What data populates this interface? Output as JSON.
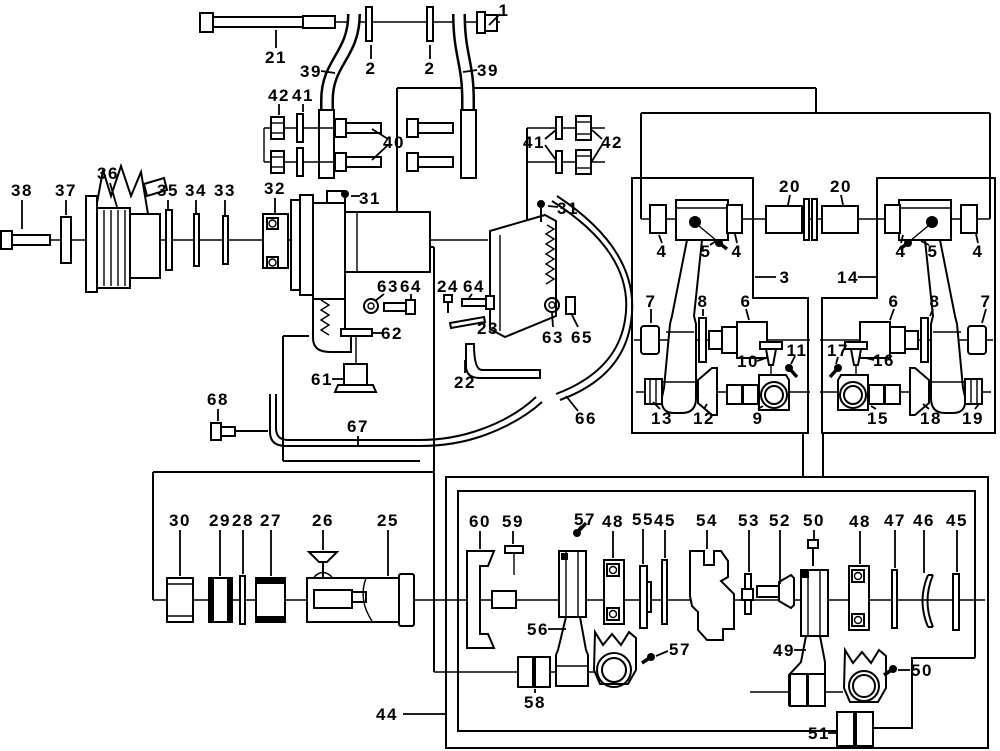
{
  "canvas": {
    "width": 1000,
    "height": 751,
    "background": "#ffffff",
    "line_color": "#000000"
  },
  "diagram": {
    "type": "exploded-parts-diagram",
    "description": "mechanical exploded parts diagram with numbered callouts",
    "part_labels": [
      {
        "text": "1",
        "x": 504,
        "y": 10,
        "leaders": [
          [
            500,
            14,
            489,
            25
          ]
        ]
      },
      {
        "text": "21",
        "x": 276,
        "y": 57,
        "leaders": [
          [
            276,
            48,
            276,
            30
          ]
        ]
      },
      {
        "text": "39",
        "x": 311,
        "y": 71,
        "leaders": [
          [
            321,
            71,
            335,
            73
          ]
        ]
      },
      {
        "text": "2",
        "x": 371,
        "y": 68,
        "leaders": [
          [
            371,
            59,
            371,
            45
          ]
        ]
      },
      {
        "text": "2",
        "x": 430,
        "y": 68,
        "leaders": [
          [
            430,
            59,
            430,
            45
          ]
        ]
      },
      {
        "text": "39",
        "x": 488,
        "y": 70,
        "leaders": [
          [
            477,
            70,
            463,
            72
          ]
        ]
      },
      {
        "text": "42",
        "x": 279,
        "y": 95,
        "leaders": [
          [
            279,
            104,
            279,
            115
          ]
        ]
      },
      {
        "text": "41",
        "x": 303,
        "y": 95,
        "leaders": [
          [
            303,
            104,
            303,
            112
          ]
        ]
      },
      {
        "text": "40",
        "x": 394,
        "y": 142,
        "leaders": [
          [
            388,
            139,
            372,
            129
          ],
          [
            388,
            145,
            372,
            160
          ]
        ]
      },
      {
        "text": "41",
        "x": 534,
        "y": 142,
        "leaders": [
          [
            545,
            139,
            556,
            130
          ],
          [
            545,
            145,
            556,
            160
          ]
        ]
      },
      {
        "text": "42",
        "x": 612,
        "y": 142,
        "leaders": [
          [
            602,
            139,
            592,
            130
          ],
          [
            602,
            145,
            592,
            161
          ]
        ]
      },
      {
        "text": "31",
        "x": 370,
        "y": 198,
        "leaders": [
          [
            360,
            196,
            351,
            196
          ]
        ]
      },
      {
        "text": "31",
        "x": 568,
        "y": 208,
        "leaders": [
          [
            558,
            207,
            548,
            206
          ]
        ]
      },
      {
        "text": "38",
        "x": 22,
        "y": 190,
        "leaders": [
          [
            22,
            200,
            22,
            229
          ]
        ]
      },
      {
        "text": "37",
        "x": 66,
        "y": 190,
        "leaders": [
          [
            66,
            200,
            66,
            215
          ]
        ]
      },
      {
        "text": "36",
        "x": 108,
        "y": 173,
        "leaders": [
          [
            110,
            183,
            117,
            207
          ]
        ]
      },
      {
        "text": "35",
        "x": 168,
        "y": 190,
        "leaders": [
          [
            168,
            200,
            168,
            209
          ]
        ]
      },
      {
        "text": "34",
        "x": 196,
        "y": 190,
        "leaders": [
          [
            196,
            200,
            196,
            213
          ]
        ]
      },
      {
        "text": "33",
        "x": 225,
        "y": 190,
        "leaders": [
          [
            225,
            200,
            225,
            215
          ]
        ]
      },
      {
        "text": "32",
        "x": 275,
        "y": 188,
        "leaders": [
          [
            275,
            198,
            275,
            213
          ]
        ]
      },
      {
        "text": "63",
        "x": 388,
        "y": 286,
        "leaders": [
          [
            384,
            294,
            375,
            301
          ]
        ]
      },
      {
        "text": "64",
        "x": 411,
        "y": 286,
        "leaders": [
          [
            411,
            294,
            411,
            299
          ]
        ]
      },
      {
        "text": "24",
        "x": 448,
        "y": 286,
        "leaders": [
          [
            448,
            294,
            448,
            294
          ]
        ]
      },
      {
        "text": "64",
        "x": 474,
        "y": 286,
        "leaders": [
          [
            472,
            294,
            469,
            298
          ]
        ]
      },
      {
        "text": "23",
        "x": 488,
        "y": 328,
        "leaders": [
          [
            479,
            325,
            486,
            322
          ]
        ]
      },
      {
        "text": "62",
        "x": 392,
        "y": 333,
        "leaders": [
          [
            382,
            333,
            373,
            333
          ]
        ]
      },
      {
        "text": "61",
        "x": 322,
        "y": 379,
        "leaders": [
          [
            332,
            379,
            343,
            379
          ]
        ]
      },
      {
        "text": "22",
        "x": 465,
        "y": 382,
        "leaders": [
          [
            465,
            373,
            465,
            360
          ]
        ]
      },
      {
        "text": "63",
        "x": 553,
        "y": 337,
        "leaders": [
          [
            553,
            327,
            552,
            313
          ]
        ]
      },
      {
        "text": "65",
        "x": 582,
        "y": 337,
        "leaders": [
          [
            578,
            327,
            572,
            315
          ]
        ]
      },
      {
        "text": "66",
        "x": 586,
        "y": 418,
        "leaders": [
          [
            578,
            411,
            566,
            396
          ]
        ]
      },
      {
        "text": "67",
        "x": 358,
        "y": 426,
        "leaders": [
          [
            358,
            436,
            358,
            445
          ]
        ]
      },
      {
        "text": "68",
        "x": 218,
        "y": 399,
        "leaders": [
          [
            218,
            409,
            218,
            421
          ]
        ]
      },
      {
        "text": "20",
        "x": 790,
        "y": 186,
        "leaders": [
          [
            790,
            195,
            788,
            205
          ]
        ]
      },
      {
        "text": "20",
        "x": 841,
        "y": 186,
        "leaders": [
          [
            841,
            195,
            843,
            205
          ]
        ]
      },
      {
        "text": "3",
        "x": 785,
        "y": 277,
        "leaders": [
          [
            776,
            277,
            755,
            277
          ]
        ]
      },
      {
        "text": "14",
        "x": 848,
        "y": 277,
        "leaders": [
          [
            858,
            277,
            876,
            277
          ]
        ]
      },
      {
        "text": "4",
        "x": 662,
        "y": 251,
        "leaders": [
          [
            662,
            243,
            659,
            235
          ]
        ]
      },
      {
        "text": "5",
        "x": 706,
        "y": 251,
        "leaders": [
          [
            710,
            245,
            716,
            241
          ]
        ]
      },
      {
        "text": "4",
        "x": 737,
        "y": 251,
        "leaders": [
          [
            737,
            243,
            735,
            234
          ]
        ]
      },
      {
        "text": "7",
        "x": 651,
        "y": 301,
        "leaders": [
          [
            651,
            309,
            651,
            323
          ]
        ]
      },
      {
        "text": "8",
        "x": 703,
        "y": 301,
        "leaders": [
          [
            703,
            309,
            703,
            316
          ]
        ]
      },
      {
        "text": "6",
        "x": 746,
        "y": 301,
        "leaders": [
          [
            746,
            309,
            749,
            320
          ]
        ]
      },
      {
        "text": "10",
        "x": 748,
        "y": 361,
        "leaders": [
          [
            757,
            361,
            766,
            358
          ]
        ]
      },
      {
        "text": "11",
        "x": 797,
        "y": 350,
        "leaders": [
          [
            795,
            356,
            791,
            364
          ]
        ]
      },
      {
        "text": "13",
        "x": 662,
        "y": 418,
        "leaders": [
          [
            660,
            409,
            653,
            402
          ]
        ]
      },
      {
        "text": "12",
        "x": 704,
        "y": 418,
        "leaders": [
          [
            704,
            409,
            707,
            404
          ]
        ]
      },
      {
        "text": "9",
        "x": 758,
        "y": 418,
        "leaders": [
          [
            758,
            409,
            763,
            406
          ]
        ]
      },
      {
        "text": "4",
        "x": 901,
        "y": 251,
        "leaders": [
          [
            901,
            243,
            903,
            235
          ]
        ]
      },
      {
        "text": "5",
        "x": 933,
        "y": 251,
        "leaders": [
          [
            929,
            245,
            921,
            241
          ]
        ]
      },
      {
        "text": "4",
        "x": 978,
        "y": 251,
        "leaders": [
          [
            978,
            243,
            976,
            234
          ]
        ]
      },
      {
        "text": "6",
        "x": 894,
        "y": 301,
        "leaders": [
          [
            894,
            309,
            890,
            320
          ]
        ]
      },
      {
        "text": "8",
        "x": 935,
        "y": 301,
        "leaders": [
          [
            933,
            309,
            930,
            316
          ]
        ]
      },
      {
        "text": "7",
        "x": 986,
        "y": 301,
        "leaders": [
          [
            986,
            309,
            982,
            323
          ]
        ]
      },
      {
        "text": "17",
        "x": 838,
        "y": 350,
        "leaders": [
          [
            838,
            357,
            836,
            364
          ]
        ]
      },
      {
        "text": "16",
        "x": 884,
        "y": 360,
        "leaders": [
          [
            874,
            360,
            866,
            358
          ]
        ]
      },
      {
        "text": "15",
        "x": 878,
        "y": 418,
        "leaders": [
          [
            876,
            409,
            871,
            406
          ]
        ]
      },
      {
        "text": "18",
        "x": 931,
        "y": 418,
        "leaders": [
          [
            929,
            409,
            923,
            404
          ]
        ]
      },
      {
        "text": "19",
        "x": 973,
        "y": 418,
        "leaders": [
          [
            975,
            409,
            979,
            404
          ]
        ]
      },
      {
        "text": "30",
        "x": 180,
        "y": 520,
        "leaders": [
          [
            180,
            530,
            180,
            576
          ]
        ]
      },
      {
        "text": "29",
        "x": 220,
        "y": 520,
        "leaders": [
          [
            220,
            530,
            220,
            576
          ]
        ]
      },
      {
        "text": "28",
        "x": 243,
        "y": 520,
        "leaders": [
          [
            243,
            530,
            243,
            574
          ]
        ]
      },
      {
        "text": "27",
        "x": 271,
        "y": 520,
        "leaders": [
          [
            271,
            530,
            271,
            576
          ]
        ]
      },
      {
        "text": "26",
        "x": 323,
        "y": 520,
        "leaders": [
          [
            323,
            530,
            323,
            550
          ]
        ]
      },
      {
        "text": "25",
        "x": 388,
        "y": 520,
        "leaders": [
          [
            388,
            530,
            388,
            576
          ]
        ]
      },
      {
        "text": "44",
        "x": 387,
        "y": 714,
        "leaders": [
          [
            403,
            714,
            446,
            714
          ]
        ]
      },
      {
        "text": "60",
        "x": 480,
        "y": 521,
        "leaders": [
          [
            480,
            531,
            480,
            549
          ]
        ]
      },
      {
        "text": "59",
        "x": 513,
        "y": 521,
        "leaders": [
          [
            513,
            531,
            513,
            544
          ]
        ]
      },
      {
        "text": "57",
        "x": 585,
        "y": 519,
        "leaders": [
          [
            581,
            526,
            578,
            530
          ]
        ]
      },
      {
        "text": "48",
        "x": 613,
        "y": 521,
        "leaders": [
          [
            613,
            531,
            613,
            558
          ]
        ]
      },
      {
        "text": "55",
        "x": 643,
        "y": 519,
        "leaders": [
          [
            643,
            529,
            643,
            564
          ]
        ]
      },
      {
        "text": "45",
        "x": 665,
        "y": 520,
        "leaders": [
          [
            665,
            530,
            665,
            558
          ]
        ]
      },
      {
        "text": "54",
        "x": 707,
        "y": 520,
        "leaders": [
          [
            707,
            530,
            707,
            549
          ]
        ]
      },
      {
        "text": "53",
        "x": 749,
        "y": 520,
        "leaders": [
          [
            749,
            530,
            749,
            572
          ]
        ]
      },
      {
        "text": "52",
        "x": 780,
        "y": 520,
        "leaders": [
          [
            780,
            530,
            780,
            584
          ]
        ]
      },
      {
        "text": "50",
        "x": 814,
        "y": 520,
        "leaders": [
          [
            814,
            530,
            814,
            539
          ]
        ]
      },
      {
        "text": "48",
        "x": 860,
        "y": 521,
        "leaders": [
          [
            860,
            531,
            860,
            564
          ]
        ]
      },
      {
        "text": "47",
        "x": 895,
        "y": 520,
        "leaders": [
          [
            895,
            530,
            895,
            568
          ]
        ]
      },
      {
        "text": "46",
        "x": 924,
        "y": 520,
        "leaders": [
          [
            924,
            530,
            924,
            573
          ]
        ]
      },
      {
        "text": "45",
        "x": 957,
        "y": 520,
        "leaders": [
          [
            957,
            530,
            957,
            572
          ]
        ]
      },
      {
        "text": "56",
        "x": 538,
        "y": 629,
        "leaders": [
          [
            548,
            629,
            566,
            629
          ]
        ]
      },
      {
        "text": "57",
        "x": 680,
        "y": 649,
        "leaders": [
          [
            668,
            651,
            656,
            656
          ]
        ]
      },
      {
        "text": "58",
        "x": 535,
        "y": 702,
        "leaders": [
          [
            535,
            693,
            535,
            689
          ]
        ]
      },
      {
        "text": "49",
        "x": 784,
        "y": 650,
        "leaders": [
          [
            794,
            650,
            806,
            650
          ]
        ]
      },
      {
        "text": "50",
        "x": 922,
        "y": 670,
        "leaders": [
          [
            910,
            670,
            898,
            670
          ]
        ]
      },
      {
        "text": "51",
        "x": 819,
        "y": 733,
        "leaders": [
          [
            828,
            733,
            837,
            733
          ]
        ]
      }
    ]
  }
}
